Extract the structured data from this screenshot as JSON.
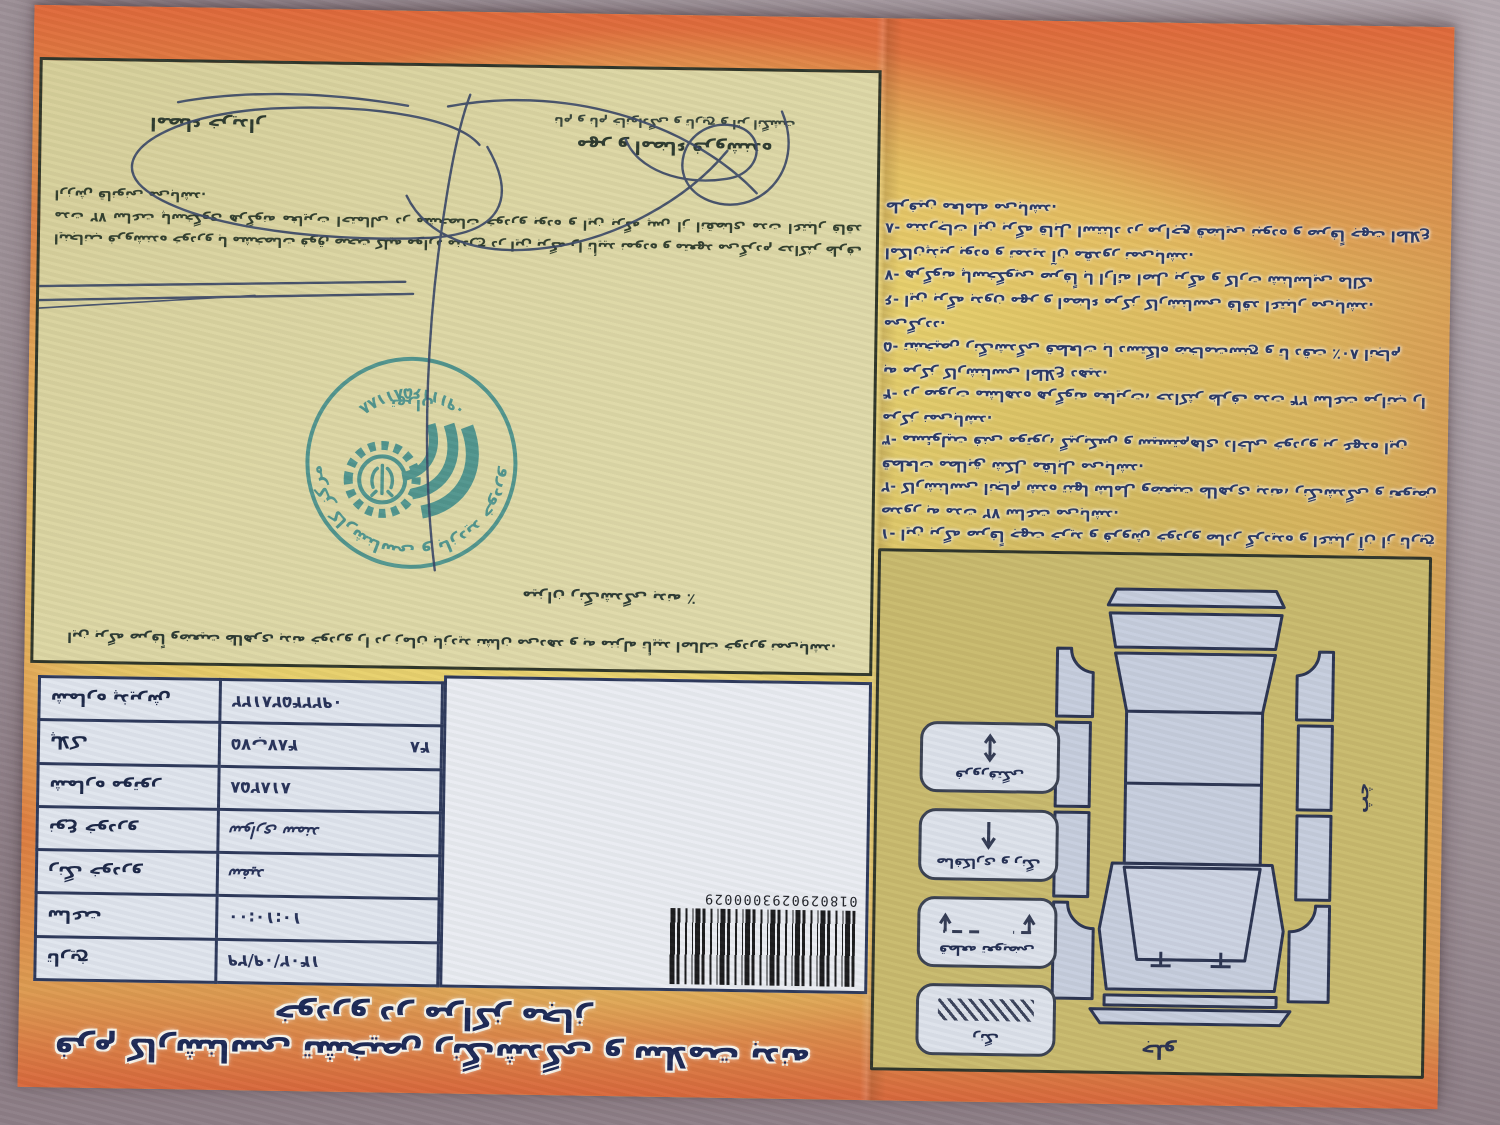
{
  "doc": {
    "banner_title": "فرم کارشناسی تشخیص رنگ‌شدگی و سلامت بدنه خودرو در مراکز مجاز",
    "barcode": {
      "number": "0180290293000029"
    },
    "table": {
      "rows": [
        {
          "label": "تاریخ",
          "value": "۱۴۰۲/۰۹/۲۹"
        },
        {
          "label": "ساعت",
          "value": "۱۰:۱۰:۰۰"
        },
        {
          "label": "رنگ خودرو",
          "value": "سفید"
        },
        {
          "label": "نوع خودرو",
          "value": "سواری سمند"
        },
        {
          "label": "شماره موتور",
          "value": "۸۱۸۲۵۸"
        },
        {
          "label": "پلاک",
          "value": "۷۵ب۴۸۷",
          "value2": "۴۸"
        },
        {
          "label": "شماره پذیرش",
          "value": "۰۹۲۲۴۵۲۸۱۲۲"
        }
      ]
    },
    "notes_box": {
      "top_note": "این برگه صرفاً وضعیت ظاهری بدنه خودرو را در زمان بازدید نشان می‌دهد و به منزله تأیید اصالت خودرو نمی‌باشد.",
      "percent_line": "میزان رنگ‌شدگی بدنه ٪",
      "paragraph": "اینجانب فروشنده خودرو با مشخصات فوق صحت کلیه موارد مندرج در این برگه را تأیید نموده و متعهد می‌گردم حداکثر ظرف مدت ۷۲ ساعت پاسخگوی هرگونه مغایرت احتمالی در مشخصات خودرو بوده و این برگه پس از انقضای مدت اعتبار فاقد ارزش قانونی می‌باشد.",
      "buyer_caption": "امضاء خریدار",
      "seller_caption": "مهر و امضاء فروشنده",
      "seller_caption_small": "نام و نام خانوادگی و تاریخ و اثر انگشت"
    },
    "stamp": {
      "arc_top": "مرکز کارشناسی و بازدید خودرو",
      "arc_bottom": "۰۹۱۱۱۶۵۸۱۱۸۸",
      "city": "تهران"
    },
    "diagram": {
      "front_label": "جلو",
      "side_label": "چپ",
      "legend": [
        {
          "label": "رنگ"
        },
        {
          "label": "قطعه تعویضی"
        },
        {
          "label": "صافکاری و رنگ"
        },
        {
          "label": "فرورفتگی"
        }
      ]
    },
    "terms": [
      "۱- این برگه صرفاً جهت خرید و فروش خودرو صادر گردیده و اعتبار آن از تاریخ صدور به مدت ۷۲ ساعت می‌باشد.",
      "۲- کارشناسی انجام شده تنها شامل وضعیت ظاهری بدنه، رنگ‌شدگی و تعویض قطعات مطابق شکل مقابل می‌باشد.",
      "۳- مسئولیت فنی موتور، گیربکس و سیستم‌های داخلی خودرو بر عهده این مرکز نمی‌باشد.",
      "۴- در صورت مشاهده هرگونه مغایرت، حداکثر ظرف مدت ۲۴ ساعت مراتب را به مرکز کارشناسی اطلاع دهید.",
      "۵- تشخیص رنگ‌شدگی قطعات با دستگاه ضخامت‌سنج و تا دقت ٪۸۰ انجام می‌گردد.",
      "۶- این برگه بدون مهر و امضاء مرکز کارشناسی فاقد اعتبار می‌باشد.",
      "۷- هرگونه پاسخگویی صرفاً با ارائه اصل برگه و کارت شناسایی مالک امکان‌پذیر بوده و تمدید آن مقدور نمی‌باشد.",
      "۸- مندرجات این برگه قابل استناد در مراجع قضایی نبوده و صرفاً جهت اطلاع طرفین معامله می‌باشد."
    ]
  }
}
